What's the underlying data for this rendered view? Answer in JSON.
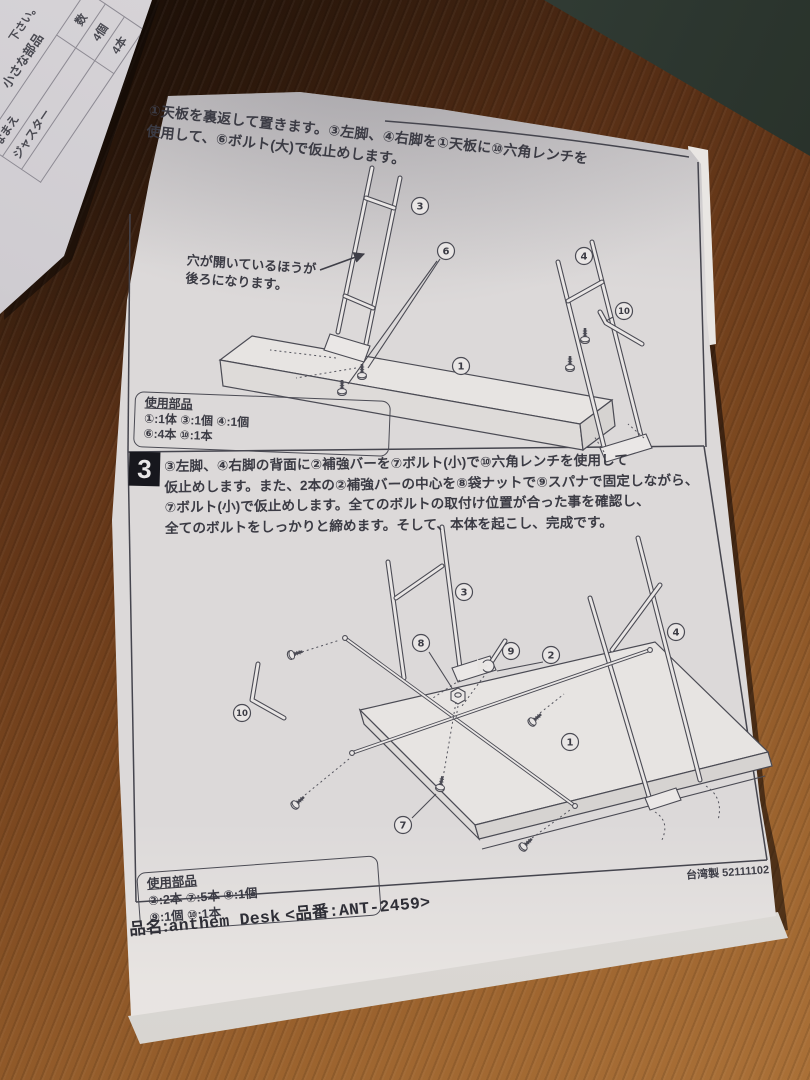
{
  "photo": {
    "wood_color": "#7c4a20",
    "mat_color": "#2f3a33",
    "paper_color": "#dcd9d9",
    "ink_color": "#3b3b44"
  },
  "under_sheet": {
    "fragment_top": "下さい。",
    "fragment_title": "小さな部品",
    "table": {
      "col_name": "なまえ",
      "col_qty": "数",
      "row1_name": "ジャスター",
      "row1_qty": "4個",
      "row2_name": "",
      "row2_qty": "4本"
    }
  },
  "step2": {
    "line1": "①天板を裏返して置きます。③左脚、④右脚を①天板に⑩六角レンチを",
    "line2": "使用して、⑥ボルト(大)で仮止めします。",
    "note_line1": "穴が開いているほうが",
    "note_line2": "後ろになります。",
    "labels": {
      "top_panel": "1",
      "left_leg": "3",
      "right_leg": "4",
      "bolt_large": "6",
      "hex_wrench": "10"
    },
    "parts": {
      "title": "使用部品",
      "line1": "①:1体 ③:1個 ④:1個",
      "line2": "⑥:4本 ⑩:1本"
    }
  },
  "step3": {
    "number": "3",
    "line1": "③左脚、④右脚の背面に②補強バーを⑦ボルト(小)で⑩六角レンチを使用して",
    "line2": "仮止めします。また、2本の②補強バーの中心を⑧袋ナットで⑨スパナで固定しながら、",
    "line3": "⑦ボルト(小)で仮止めします。全てのボルトの取付け位置が合った事を確認し、",
    "line4": "全てのボルトをしっかりと締めます。そして、本体を起こし、完成です。",
    "labels": {
      "top_panel": "1",
      "brace": "2",
      "left_leg": "3",
      "right_leg": "4",
      "bolt_small": "7",
      "cap_nut": "8",
      "spanner": "9",
      "hex_wrench": "10"
    },
    "parts": {
      "title": "使用部品",
      "line1": "②:2本 ⑦:5本 ⑧:1個",
      "line2": "⑨:1個 ⑩:1本"
    },
    "origin": "台湾製 52111102"
  },
  "footer": {
    "name_label": "品名:",
    "product": "anthem Desk",
    "code": "<品番:ANT-2459>"
  }
}
